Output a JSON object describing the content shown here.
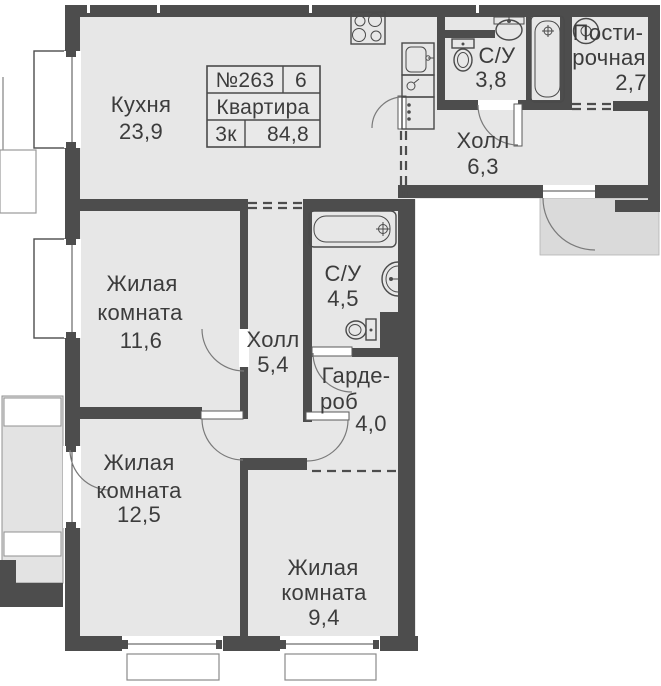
{
  "plan": {
    "title": "Floor plan of 3-room apartment",
    "apartment_card": {
      "number": "№263",
      "floor": "6",
      "type_label": "Квартира",
      "rooms_label": "3к",
      "total_area": "84,8"
    },
    "rooms": {
      "kitchen": {
        "name": "Кухня",
        "area": "23,9"
      },
      "bathroom_small": {
        "name": "С/У",
        "area": "3,8"
      },
      "laundry": {
        "name_line1": "Пости-",
        "name_line2": "рочная",
        "area": "2,7"
      },
      "hall_main": {
        "name": "Холл",
        "area": "6,3"
      },
      "living_room_1": {
        "name_line1": "Жилая",
        "name_line2": "комната",
        "area": "11,6"
      },
      "bathroom_large": {
        "name": "С/У",
        "area": "4,5"
      },
      "hall_inner": {
        "name": "Холл",
        "area": "5,4"
      },
      "wardrobe": {
        "name_line1": "Гарде-",
        "name_line2": "роб",
        "area": "4,0"
      },
      "living_room_2": {
        "name_line1": "Жилая",
        "name_line2": "комната",
        "area": "12,5"
      },
      "living_room_3": {
        "name_line1": "Жилая",
        "name_line2": "комната",
        "area": "9,4"
      }
    },
    "colors": {
      "wall": "#4d4d4d",
      "floor": "#e7e7e7",
      "balcony": "#e3e3e3",
      "entry_landing": "#dadada",
      "text": "#3c3c3c",
      "background": "#ffffff"
    },
    "fixtures": [
      "stove-icon",
      "kitchen-sink-icon",
      "fridge-icon",
      "boiler-icon",
      "toilet-icon",
      "washbasin-icon",
      "bathtub-icon",
      "washing-machine-icon"
    ]
  }
}
